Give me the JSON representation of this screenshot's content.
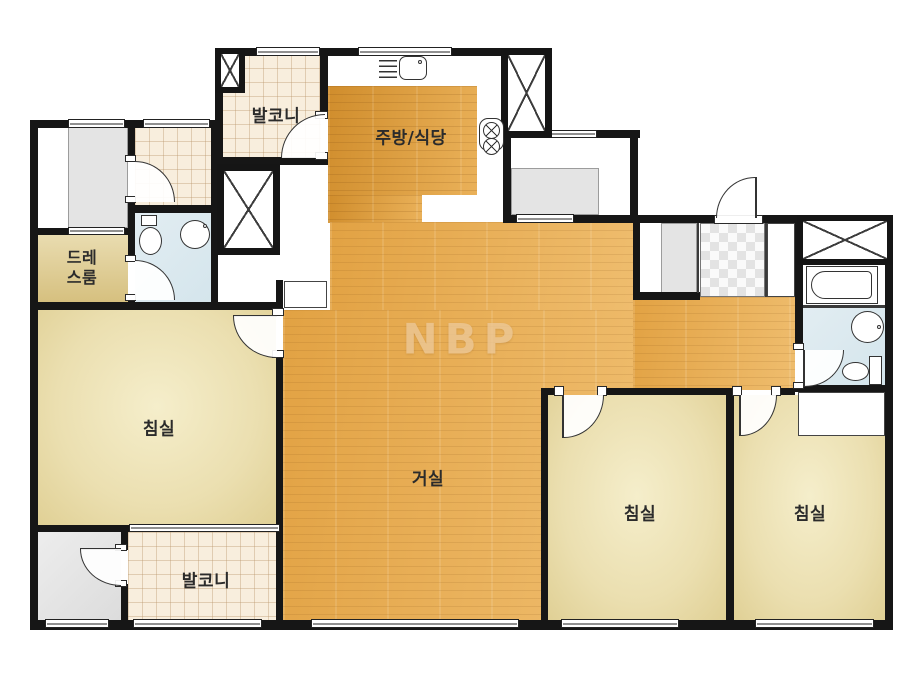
{
  "watermark": "NBP",
  "rooms": {
    "balcony_top": "발코니",
    "kitchen_dining": "주방/식당",
    "dress_room_line1": "드레",
    "dress_room_line2": "스룸",
    "bedroom_left": "침실",
    "living_room": "거실",
    "balcony_bottom": "발코니",
    "bedroom_center": "침실",
    "bedroom_right": "침실"
  },
  "colors": {
    "wall": "#161616",
    "wood_kitchen": "#d9973a",
    "wood_living": "#e6ab52",
    "bedroom_floor": "#ebdfb0",
    "dress_floor": "#e0cf97",
    "bathroom_floor": "#dbe9ef",
    "balcony_tile": "#f8eedd",
    "gray_area": "#e4e4e4",
    "watermark_color": "#ecc795"
  },
  "icons": {
    "duct-shaft": "box-with-x",
    "door-swing": "quarter-arc",
    "window": "double-line-in-wall",
    "gas-stove": "two-crossed-burners",
    "kitchen-sink": "basin-with-rack"
  }
}
